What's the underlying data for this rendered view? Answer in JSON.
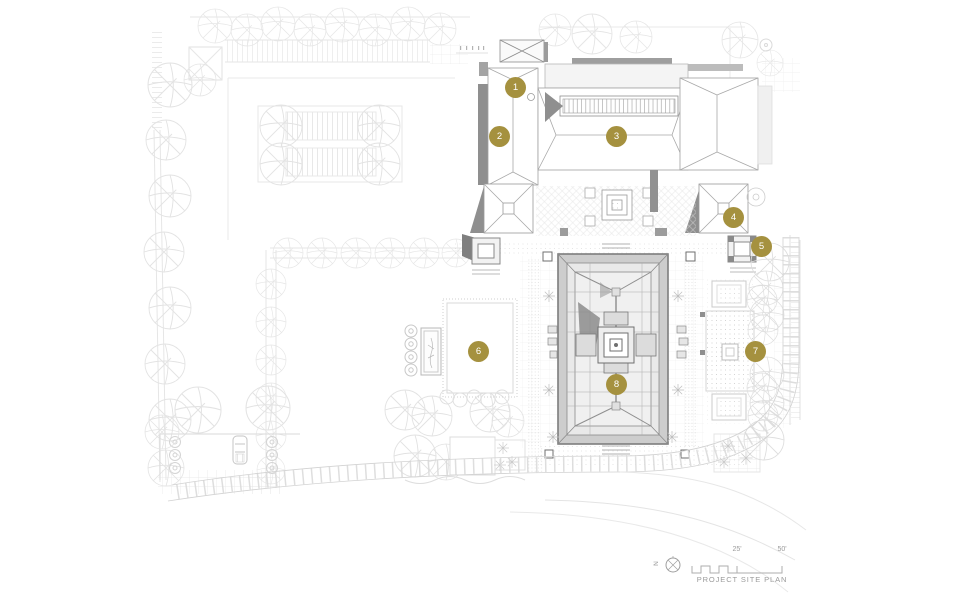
{
  "plan": {
    "caption": "PROJECT SITE PLAN",
    "north_label": "N",
    "scale_labels": [
      "25'",
      "50'"
    ],
    "markers": [
      {
        "label": "1"
      },
      {
        "label": "2"
      },
      {
        "label": "3"
      },
      {
        "label": "4"
      },
      {
        "label": "5"
      },
      {
        "label": "6"
      },
      {
        "label": "7"
      },
      {
        "label": "8"
      }
    ]
  },
  "colors": {
    "marker_fill": "#a5913f",
    "marker_text": "#ffffff",
    "drawing_line": "#9a9a9a",
    "faint_line": "#e2e2e2",
    "shadow_gray": "#8f8f8f",
    "legend_text": "#9a9a9a"
  }
}
